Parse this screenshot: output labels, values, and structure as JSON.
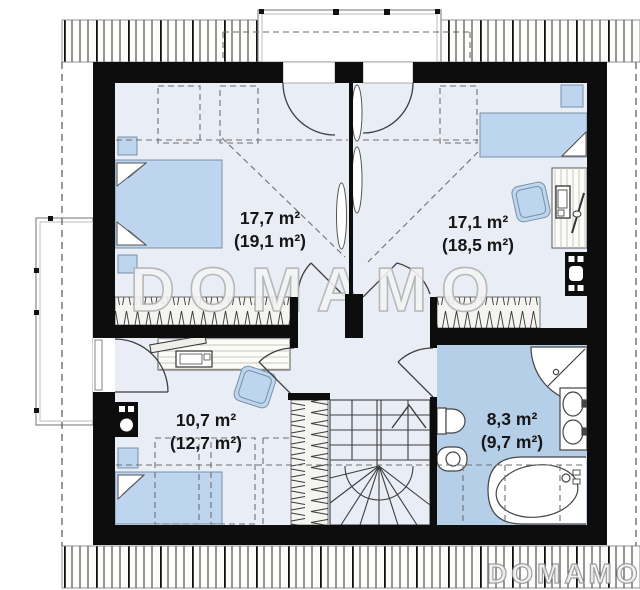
{
  "page": {
    "type": "attic-floor-plan"
  },
  "watermarks": {
    "center": "DOMAMO",
    "bottom_right": "DOMAMO"
  },
  "rooms": [
    {
      "name": "bedroom-top-left",
      "area": "17,7 m²",
      "area_gross": "(19,1 m²)"
    },
    {
      "name": "bedroom-top-right",
      "area": "17,1 m²",
      "area_gross": "(18,5 m²)"
    },
    {
      "name": "bedroom-bottom-left",
      "area": "10,7 m²",
      "area_gross": "(12,7 m²)"
    },
    {
      "name": "bathroom",
      "area": "8,3 m²",
      "area_gross": "(9,7 m²)"
    }
  ],
  "colors": {
    "wall": "#0d0d0d",
    "floor": "#e9eef6",
    "bathroom_floor": "#b6cfe8",
    "furniture": "#bdd5ee",
    "eave_band": "#fdfdfb",
    "wardrobe_band": "#f4f4f1",
    "watermark_outline": "#b5b5b5"
  }
}
